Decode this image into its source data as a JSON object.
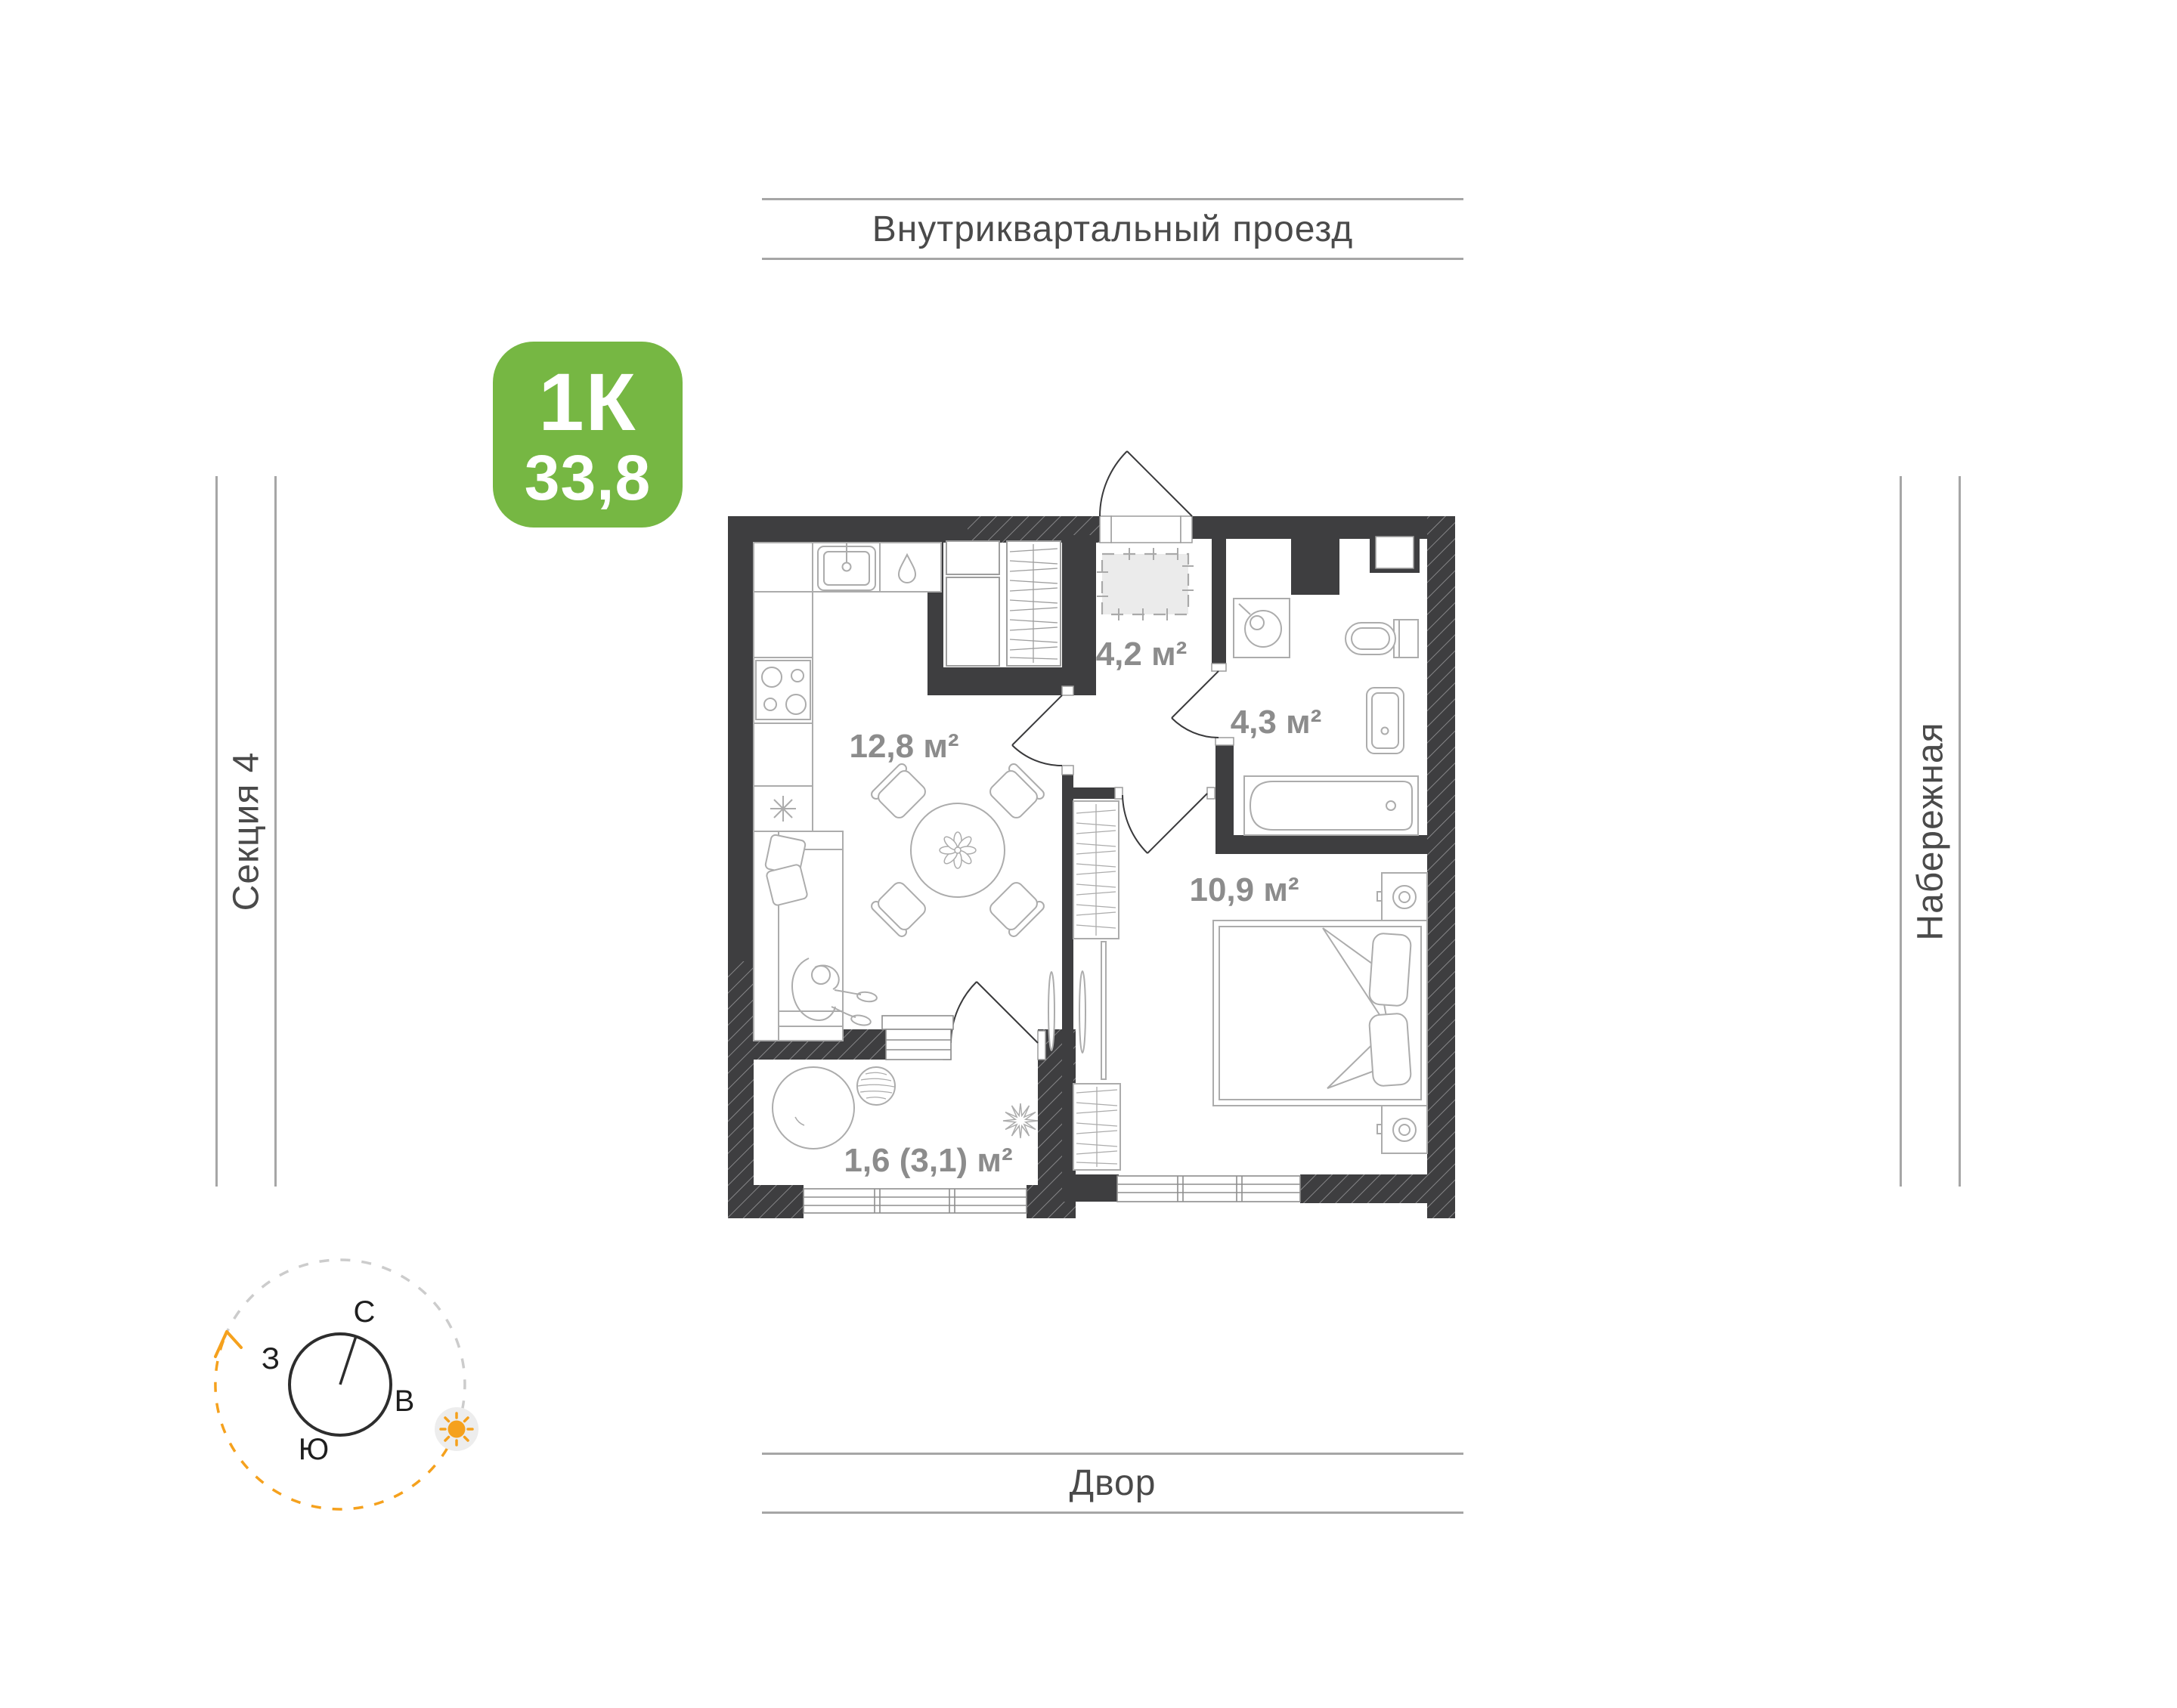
{
  "streets": {
    "top": "Внутриквартальный проезд",
    "bottom": "Двор",
    "left": "Секция 4",
    "right": "Набережная"
  },
  "badge": {
    "rooms_label": "1К",
    "area_value": "33,8",
    "color": "#76b743"
  },
  "compass": {
    "north": "С",
    "east": "В",
    "south": "Ю",
    "west": "З",
    "sun_color": "#f5a11d"
  },
  "plan": {
    "rooms": [
      {
        "name": "kitchen-living",
        "area_label": "12,8 м²"
      },
      {
        "name": "hall",
        "area_label": "4,2 м²"
      },
      {
        "name": "bathroom",
        "area_label": "4,3 м²"
      },
      {
        "name": "bedroom",
        "area_label": "10,9 м²"
      },
      {
        "name": "balcony",
        "area_label": "1,6 (3,1) м²"
      }
    ],
    "colors": {
      "wall": "#3e3e40",
      "furniture_line": "#acacac",
      "room_label": "#8c8c8c",
      "street_text": "#4a4a4a"
    }
  }
}
